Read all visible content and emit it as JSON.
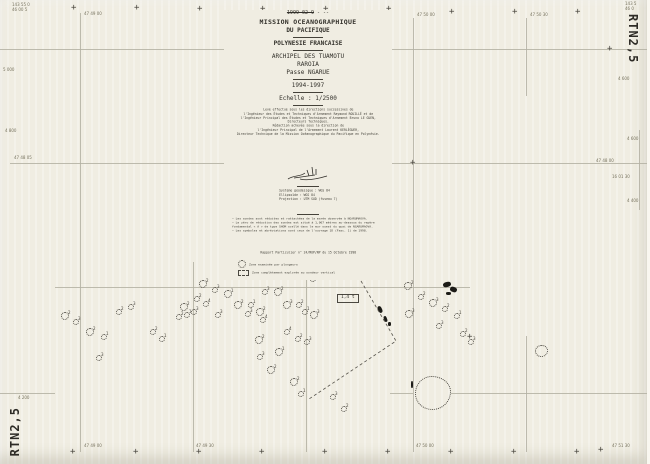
{
  "colors": {
    "paper": "#f0ede2",
    "grid_line": "#b3b0a2",
    "ink": "#33312b",
    "ink_faint": "#77735f",
    "symbol": "#4b4840",
    "black": "#1c1b17"
  },
  "sheet_code": "RTN2,5",
  "title_block": {
    "date_struck": "1999-02-9",
    "date_suffix": " - --",
    "org_line1": "MISSION OCEANOGRAPHIQUE",
    "org_line2": "DU PACIFIQUE",
    "territory": "POLYNESIE FRANCAISE",
    "archipelago": "ARCHIPEL DES TUAMOTU",
    "atoll": "RAROIA",
    "pass": "Passe NGARUE",
    "years": "1994-1997",
    "scale": "Echelle : 1/2500",
    "attribution_lines": [
      "Levé effectué sous les directions successives de",
      "l'Ingénieur des Études et Techniques d'Armement Raymond ROUILLÉ et de",
      "l'Ingénieur Principal des Études et Techniques d'Armement Bruno LE GUEN,",
      "Directeurs Techniques.",
      "Rédaction achevée sous la direction de",
      "l'Ingénieur Principal de l'Armement Laurent KERLÉGUER,",
      "Directeur Technique de la Mission Océanographique du Pacifique en Polynésie."
    ],
    "geodesy_lines": [
      "Système géodésique : WGS 84",
      "Ellipsoïde        : WGS 84",
      "Projection        : UTM SUD (fuseau 7)"
    ],
    "notes_lines": [
      "— Les sondes sont réduites et rattachées de la marée observée à NGARUMAOVA.",
      "— Le zéro de réduction des sondes est situé à 1,067 mètres au-dessous du repère",
      "  fondamental « A » de type SHOM scellé dans le mur ouest du quai de NGARUMAOVA.",
      "— Les symboles et abréviations sont ceux de l'ouvrage 1D (Fasc. 1) de 1998."
    ],
    "report_line": "Rapport Particulier n° 24/MOP/NP du 15 Octobre 1998",
    "legend": [
      {
        "symbol": "dotted-circle",
        "label": "Zone examinée par plongeurs"
      },
      {
        "symbol": "dashed-area",
        "label": "Zone complètement explorée au sondeur vertical"
      }
    ]
  },
  "map": {
    "grid": {
      "v_lines": [
        {
          "x": 80,
          "y1": 13,
          "y2": 452
        },
        {
          "x": 193,
          "y1": 262,
          "y2": 452
        },
        {
          "x": 306,
          "y1": 262,
          "y2": 452
        },
        {
          "x": 413,
          "y1": 18,
          "y2": 452
        },
        {
          "x": 526,
          "y1": 18,
          "y2": 96
        },
        {
          "x": 526,
          "y1": 336,
          "y2": 452
        },
        {
          "x": 639,
          "y1": 130,
          "y2": 210
        }
      ],
      "h_lines": [
        {
          "y": 49,
          "x1": 0,
          "x2": 650
        },
        {
          "y": 163,
          "x1": 10,
          "x2": 650
        },
        {
          "y": 287,
          "x1": 55,
          "x2": 470
        },
        {
          "y": 393,
          "x1": 0,
          "x2": 55
        },
        {
          "y": 393,
          "x1": 390,
          "x2": 413
        },
        {
          "y": 393,
          "x1": 451,
          "x2": 650
        }
      ]
    },
    "crosses": [
      [
        74,
        8
      ],
      [
        137,
        8
      ],
      [
        200,
        9
      ],
      [
        263,
        9
      ],
      [
        326,
        9
      ],
      [
        389,
        9
      ],
      [
        452,
        12
      ],
      [
        515,
        12
      ],
      [
        578,
        12
      ],
      [
        73,
        452
      ],
      [
        136,
        452
      ],
      [
        199,
        452
      ],
      [
        262,
        452
      ],
      [
        325,
        452
      ],
      [
        388,
        452
      ],
      [
        451,
        452
      ],
      [
        514,
        452
      ],
      [
        577,
        452
      ],
      [
        413,
        163
      ],
      [
        470,
        337
      ],
      [
        357,
        228
      ],
      [
        610,
        49
      ],
      [
        601,
        450
      ]
    ],
    "edge_labels": [
      {
        "x": 12,
        "y": 3,
        "text": "143 55 0"
      },
      {
        "x": 12,
        "y": 8,
        "text": "46 00 5"
      },
      {
        "x": 84,
        "y": 12,
        "text": "47 49 00"
      },
      {
        "x": 417,
        "y": 13,
        "text": "47 50 00"
      },
      {
        "x": 530,
        "y": 13,
        "text": "47 50 30"
      },
      {
        "x": 625,
        "y": 2,
        "text": "143 5"
      },
      {
        "x": 625,
        "y": 7,
        "text": "46 0"
      },
      {
        "x": 3,
        "y": 68,
        "text": "5 000"
      },
      {
        "x": 5,
        "y": 129,
        "text": "4 800"
      },
      {
        "x": 14,
        "y": 156,
        "text": "47 48 05"
      },
      {
        "x": 596,
        "y": 159,
        "text": "47 48 00"
      },
      {
        "x": 627,
        "y": 137,
        "text": "4 600"
      },
      {
        "x": 612,
        "y": 175,
        "text": "16 01 30"
      },
      {
        "x": 627,
        "y": 199,
        "text": "4 400"
      },
      {
        "x": 618,
        "y": 77,
        "text": "4 600"
      },
      {
        "x": 18,
        "y": 396,
        "text": "4 200"
      },
      {
        "x": 84,
        "y": 444,
        "text": "47 49 00"
      },
      {
        "x": 196,
        "y": 444,
        "text": "47 49 30"
      },
      {
        "x": 416,
        "y": 444,
        "text": "47 50 00"
      },
      {
        "x": 612,
        "y": 444,
        "text": "47 51 30"
      }
    ],
    "coral_heads": [
      [
        202,
        283,
        3,
        "2"
      ],
      [
        214,
        289,
        2,
        "3"
      ],
      [
        227,
        293,
        3,
        "1"
      ],
      [
        196,
        298,
        2,
        "2"
      ],
      [
        205,
        303,
        2,
        "4"
      ],
      [
        183,
        306,
        3,
        "2"
      ],
      [
        193,
        311,
        2,
        "3"
      ],
      [
        186,
        314,
        2,
        "1"
      ],
      [
        178,
        316,
        2,
        "2"
      ],
      [
        217,
        314,
        2,
        "3"
      ],
      [
        237,
        304,
        3,
        "2"
      ],
      [
        250,
        304,
        2,
        "1"
      ],
      [
        247,
        313,
        2,
        "3"
      ],
      [
        259,
        311,
        3,
        "2"
      ],
      [
        262,
        319,
        2,
        "4"
      ],
      [
        277,
        291,
        3,
        "2"
      ],
      [
        264,
        291,
        2,
        "3"
      ],
      [
        298,
        276,
        2,
        "1"
      ],
      [
        312,
        278,
        2,
        "2"
      ],
      [
        286,
        304,
        3,
        "3"
      ],
      [
        298,
        304,
        2,
        "2"
      ],
      [
        304,
        311,
        2,
        "1"
      ],
      [
        313,
        314,
        3,
        "3"
      ],
      [
        258,
        339,
        3,
        "2"
      ],
      [
        278,
        351,
        3,
        "1"
      ],
      [
        259,
        356,
        2,
        "3"
      ],
      [
        270,
        369,
        3,
        "2"
      ],
      [
        286,
        331,
        2,
        "4"
      ],
      [
        297,
        338,
        2,
        "2"
      ],
      [
        306,
        341,
        2,
        "3"
      ],
      [
        293,
        381,
        3,
        "2"
      ],
      [
        300,
        393,
        2,
        "1"
      ],
      [
        332,
        396,
        2,
        "3"
      ],
      [
        343,
        408,
        2,
        "2"
      ],
      [
        64,
        315,
        3,
        "2"
      ],
      [
        75,
        321,
        2,
        "3"
      ],
      [
        89,
        331,
        3,
        "2"
      ],
      [
        103,
        336,
        2,
        "1"
      ],
      [
        118,
        311,
        2,
        "2"
      ],
      [
        130,
        306,
        2,
        "3"
      ],
      [
        152,
        331,
        2,
        "2"
      ],
      [
        161,
        338,
        2,
        "1"
      ],
      [
        98,
        357,
        2,
        "3"
      ],
      [
        352,
        268,
        2,
        "2"
      ],
      [
        363,
        274,
        2,
        "3"
      ],
      [
        231,
        263,
        2,
        "2"
      ],
      [
        407,
        285,
        3,
        "2"
      ],
      [
        408,
        313,
        3,
        "3"
      ],
      [
        420,
        296,
        2,
        "2"
      ],
      [
        432,
        302,
        3,
        "3"
      ],
      [
        444,
        308,
        2,
        "2"
      ],
      [
        456,
        315,
        2,
        "1"
      ],
      [
        438,
        325,
        2,
        "3"
      ],
      [
        462,
        333,
        2,
        "2"
      ],
      [
        470,
        341,
        2,
        "3"
      ]
    ],
    "patches": [
      {
        "x": 415,
        "y": 376,
        "w": 34,
        "h": 32,
        "br": "46% 54% 52% 48% / 52% 46% 55% 48%"
      },
      {
        "x": 535,
        "y": 345,
        "w": 11,
        "h": 10,
        "br": "50% 46% 52% 48%"
      }
    ],
    "islets": [
      [
        443,
        282,
        8,
        5,
        -15
      ],
      [
        450,
        287,
        7,
        5,
        20
      ],
      [
        446,
        292,
        5,
        3,
        0
      ],
      [
        378,
        306,
        4,
        7,
        -25
      ],
      [
        384,
        316,
        3,
        6,
        -20
      ],
      [
        388,
        322,
        3,
        4,
        0
      ],
      [
        411,
        381,
        2,
        7,
        0
      ]
    ],
    "dashed_boundary_points": "361,281 396,341 309,399",
    "boxed_label": {
      "x": 337,
      "y": 294,
      "text": "1,4 t"
    }
  }
}
